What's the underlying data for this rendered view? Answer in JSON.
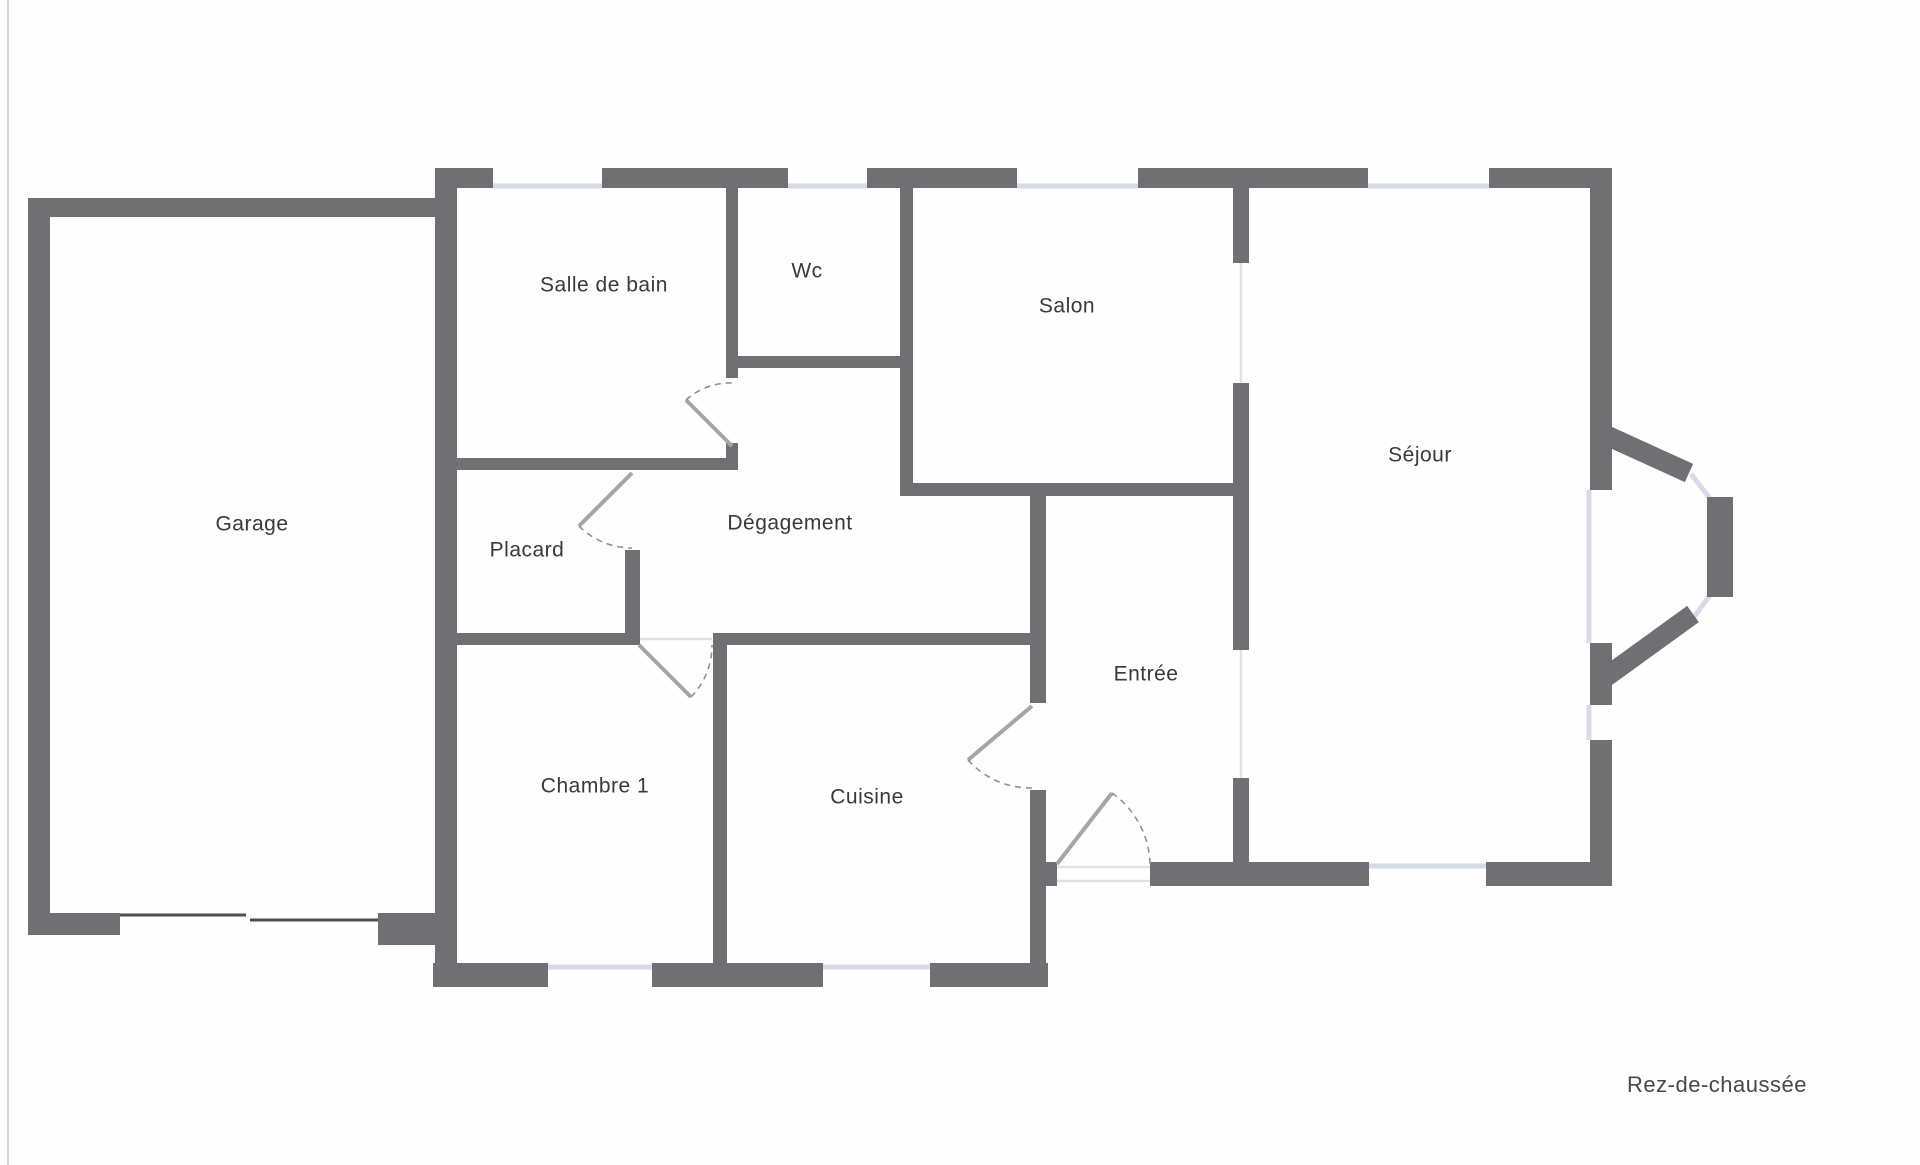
{
  "page": {
    "width": 1920,
    "height": 1165,
    "background": "#fefefe",
    "edge_line_color": "#d8d8d8"
  },
  "footer": {
    "label": "Rez-de-chaussée",
    "x": 1717,
    "y": 1086,
    "font_size": 22,
    "color": "#48484b"
  },
  "plan": {
    "colors": {
      "wall": "#6f7073",
      "window": "#d7dbe8",
      "passage": "#e1e1e5",
      "door_leaf": "#a6a6a9",
      "door_arc": "#909093",
      "garage_door": "#4f4f52",
      "label": "#39393b"
    },
    "label_font_size": 21,
    "walls": [
      [
        28,
        198,
        22,
        737
      ],
      [
        28,
        198,
        407,
        19
      ],
      [
        28,
        913,
        92,
        22
      ],
      [
        378,
        913,
        57,
        32
      ],
      [
        435,
        168,
        22,
        819
      ],
      [
        435,
        168,
        58,
        20
      ],
      [
        602,
        168,
        186,
        20
      ],
      [
        867,
        168,
        150,
        20
      ],
      [
        1138,
        168,
        230,
        20
      ],
      [
        1489,
        168,
        123,
        20
      ],
      [
        1590,
        168,
        22,
        322
      ],
      [
        1590,
        643,
        22,
        62
      ],
      [
        1590,
        740,
        22,
        146
      ],
      [
        1486,
        862,
        126,
        24
      ],
      [
        1150,
        862,
        219,
        24
      ],
      [
        1030,
        862,
        27,
        24
      ],
      [
        1030,
        483,
        16,
        220
      ],
      [
        1030,
        790,
        16,
        197
      ],
      [
        433,
        963,
        115,
        24
      ],
      [
        652,
        963,
        171,
        24
      ],
      [
        930,
        963,
        118,
        24
      ],
      [
        713,
        633,
        14,
        354
      ],
      [
        435,
        633,
        202,
        12
      ],
      [
        713,
        633,
        333,
        12
      ],
      [
        625,
        550,
        15,
        95
      ],
      [
        450,
        458,
        287,
        12
      ],
      [
        726,
        443,
        12,
        27
      ],
      [
        726,
        188,
        12,
        190
      ],
      [
        726,
        356,
        179,
        12
      ],
      [
        900,
        188,
        13,
        308
      ],
      [
        900,
        483,
        349,
        13
      ],
      [
        1233,
        188,
        16,
        75
      ],
      [
        1233,
        383,
        16,
        267
      ],
      [
        1233,
        778,
        16,
        108
      ],
      [
        1707,
        497,
        26,
        100
      ]
    ],
    "diag_walls": [
      [
        1599,
        432,
        1689,
        473
      ],
      [
        1599,
        682,
        1693,
        614
      ]
    ],
    "windows": [
      [
        493,
        186,
        602,
        186
      ],
      [
        788,
        186,
        867,
        186
      ],
      [
        1017,
        186,
        1138,
        186
      ],
      [
        1368,
        186,
        1489,
        186
      ],
      [
        1589,
        490,
        1589,
        643
      ],
      [
        1589,
        705,
        1589,
        740
      ],
      [
        1691,
        474,
        1712,
        501
      ],
      [
        1710,
        595,
        1694,
        617
      ],
      [
        1369,
        866,
        1486,
        866
      ],
      [
        548,
        967,
        652,
        967
      ],
      [
        823,
        967,
        930,
        967
      ]
    ],
    "passages": [
      [
        1241,
        263,
        1241,
        383
      ],
      [
        1241,
        650,
        1241,
        778
      ],
      [
        1057,
        867,
        1150,
        867
      ],
      [
        1057,
        881,
        1150,
        881
      ],
      [
        640,
        639,
        712,
        639
      ]
    ],
    "garage_door": [
      [
        120,
        915,
        246,
        915
      ],
      [
        250,
        920,
        378,
        920
      ]
    ],
    "doors": [
      {
        "id": "salle-de-bain-door",
        "hinge": [
          732,
          446
        ],
        "leaf_end": [
          686,
          400
        ],
        "arc_to": [
          732,
          383
        ],
        "sweep": 1
      },
      {
        "id": "placard-door",
        "hinge": [
          632,
          473
        ],
        "leaf_end": [
          579,
          526
        ],
        "arc_to": [
          632,
          548
        ],
        "sweep": 0
      },
      {
        "id": "chambre-door",
        "hinge": [
          639,
          645
        ],
        "leaf_end": [
          691,
          697
        ],
        "arc_to": [
          712,
          645
        ],
        "sweep": 0
      },
      {
        "id": "cuisine-door",
        "hinge": [
          1032,
          706
        ],
        "leaf_end": [
          968,
          760
        ],
        "arc_to": [
          1032,
          788
        ],
        "sweep": 0
      },
      {
        "id": "entree-door",
        "hinge": [
          1057,
          864
        ],
        "leaf_end": [
          1112,
          793
        ],
        "arc_to": [
          1150,
          864
        ],
        "sweep": 1
      }
    ],
    "rooms": [
      {
        "id": "garage",
        "name": "Garage",
        "x": 252,
        "y": 525
      },
      {
        "id": "salle-de-bain",
        "name": "Salle de bain",
        "x": 604,
        "y": 286
      },
      {
        "id": "wc",
        "name": "Wc",
        "x": 807,
        "y": 272
      },
      {
        "id": "salon",
        "name": "Salon",
        "x": 1067,
        "y": 307
      },
      {
        "id": "sejour",
        "name": "Séjour",
        "x": 1420,
        "y": 456
      },
      {
        "id": "placard",
        "name": "Placard",
        "x": 527,
        "y": 551
      },
      {
        "id": "degagement",
        "name": "Dégagement",
        "x": 790,
        "y": 524
      },
      {
        "id": "chambre-1",
        "name": "Chambre 1",
        "x": 595,
        "y": 787
      },
      {
        "id": "cuisine",
        "name": "Cuisine",
        "x": 867,
        "y": 798
      },
      {
        "id": "entree",
        "name": "Entrée",
        "x": 1146,
        "y": 675
      }
    ]
  }
}
